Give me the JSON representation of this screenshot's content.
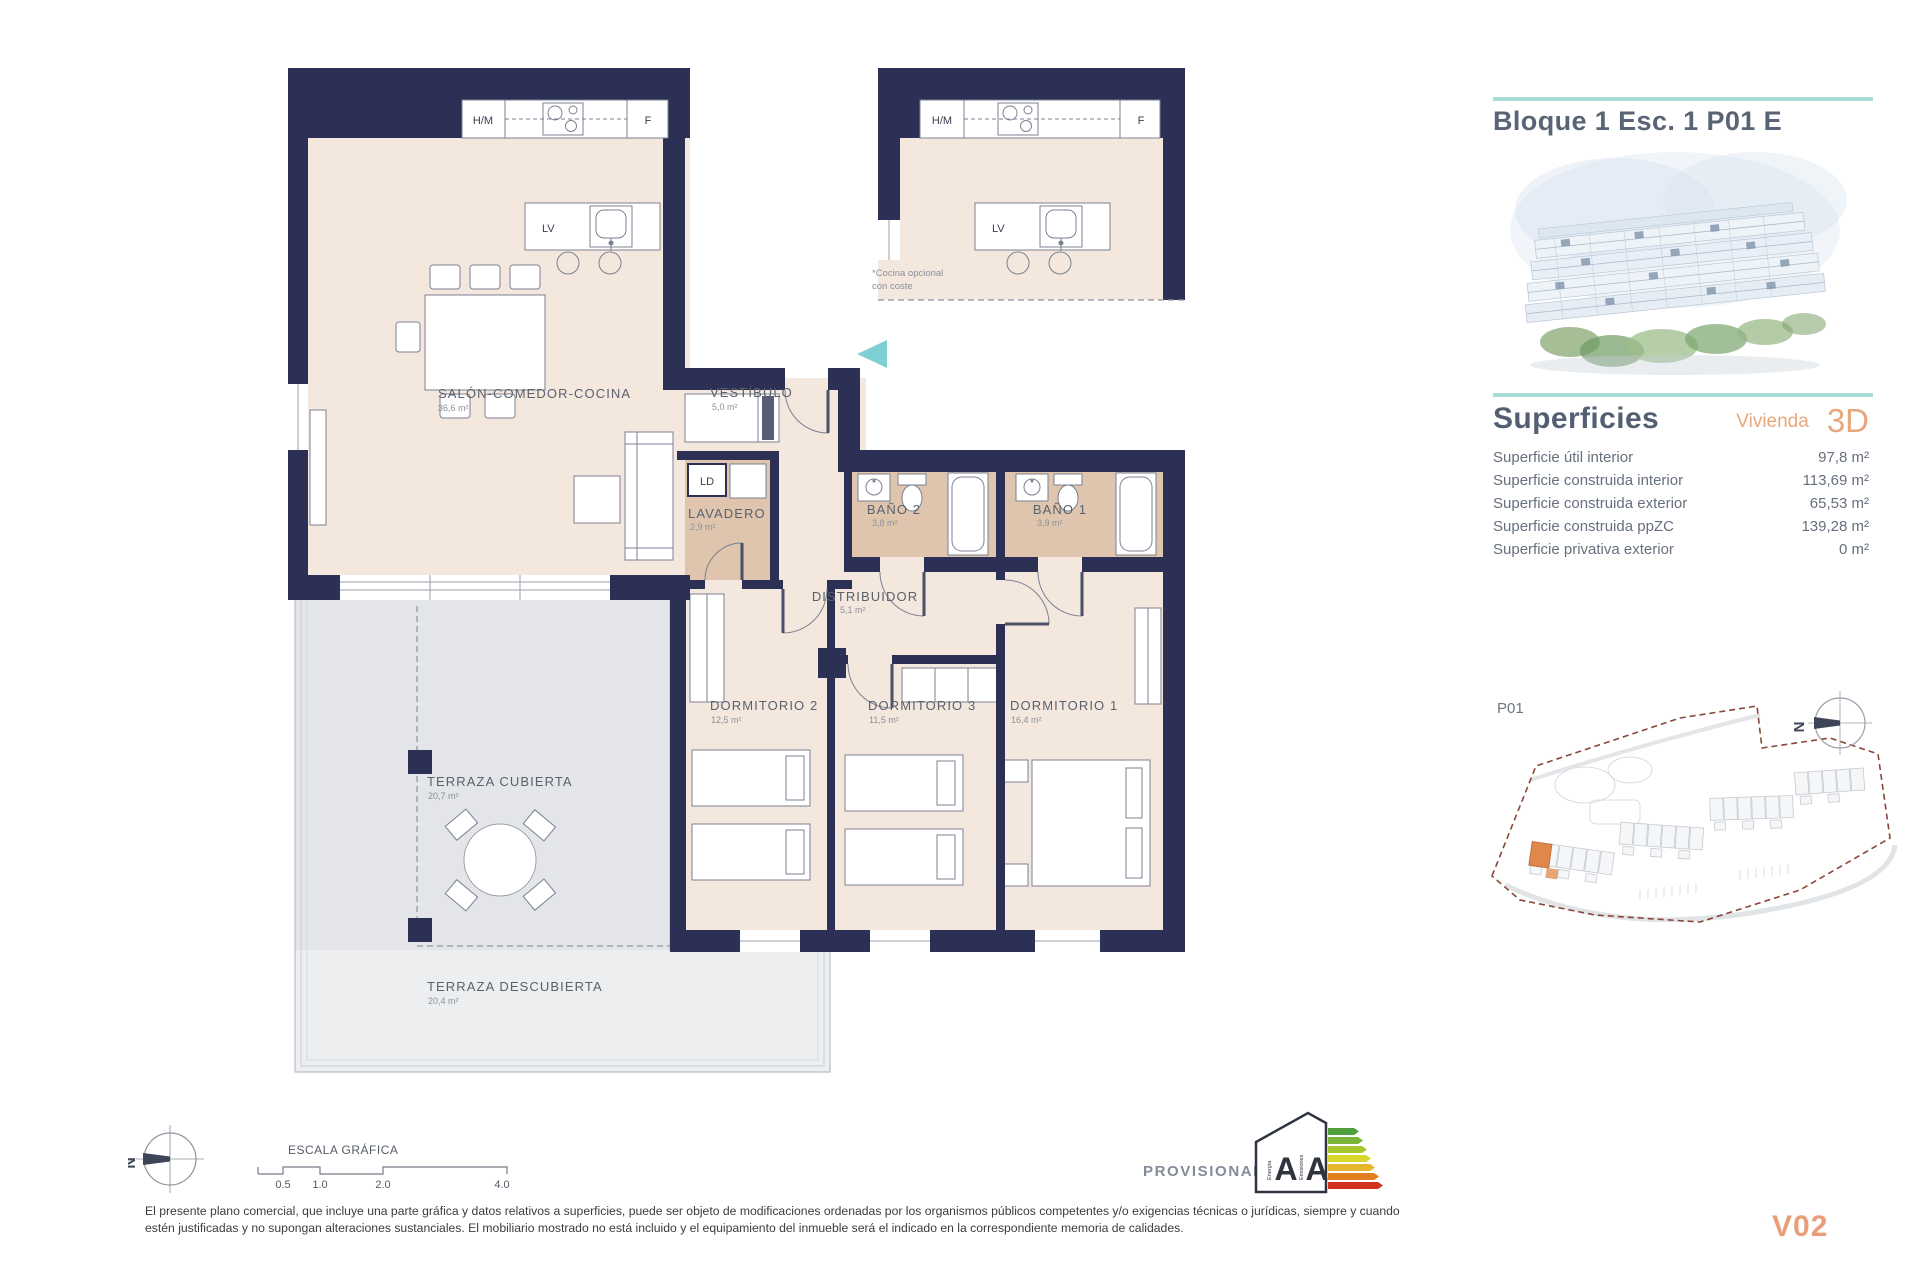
{
  "header": {
    "title": "Bloque 1 Esc. 1 P01 E"
  },
  "superficies": {
    "title": "Superficies",
    "subtitle": "Vivienda",
    "badge": "3D",
    "rows": [
      {
        "label": "Superficie útil interior",
        "value": "97,8 m²"
      },
      {
        "label": "Superficie construida interior",
        "value": "113,69 m²"
      },
      {
        "label": "Superficie construida exterior",
        "value": "65,53 m²"
      },
      {
        "label": "Superficie construida ppZC",
        "value": "139,28 m²"
      },
      {
        "label": "Superficie privativa exterior",
        "value": "0 m²"
      }
    ]
  },
  "siteplan": {
    "label": "P01"
  },
  "plan": {
    "kitchen": {
      "hm": "H/M",
      "f": "F",
      "lv": "LV",
      "ld": "LD"
    },
    "rooms": {
      "salon": {
        "name": "SALÓN-COMEDOR-COCINA",
        "area": "36,6 m²"
      },
      "vestibulo": {
        "name": "VESTÍBULO",
        "area": "5,0 m²"
      },
      "lavadero": {
        "name": "LAVADERO",
        "area": "2,9 m²"
      },
      "bano2": {
        "name": "BAÑO 2",
        "area": "3,8 m²"
      },
      "bano1": {
        "name": "BAÑO 1",
        "area": "3,9 m²"
      },
      "distribuidor": {
        "name": "DISTRIBUIDOR",
        "area": "5,1 m²"
      },
      "dorm2": {
        "name": "DORMITORIO 2",
        "area": "12,5 m²"
      },
      "dorm3": {
        "name": "DORMITORIO 3",
        "area": "11,5 m²"
      },
      "dorm1": {
        "name": "DORMITORIO 1",
        "area": "16,4 m²"
      },
      "terraza_cubierta": {
        "name": "TERRAZA CUBIERTA",
        "area": "20,7 m²"
      },
      "terraza_descubierta": {
        "name": "TERRAZA DESCUBIERTA",
        "area": "20,4 m²"
      }
    },
    "note_line1": "*Cocina opcional",
    "note_line2": "con coste"
  },
  "scale": {
    "title": "ESCALA GRÁFICA",
    "t1": "0.5",
    "t2": "1.0",
    "t3": "2.0",
    "t4": "4.0"
  },
  "compass": {
    "n": "N"
  },
  "energy": {
    "a1": "A",
    "a2": "A",
    "w1": "Energía",
    "w2": "Emisiones"
  },
  "footer": {
    "provisional": "PROVISIONAL",
    "version": "V02",
    "disclaimer": "El presente plano comercial, que incluye una parte gráfica y datos relativos a superficies, puede ser objeto de modificaciones ordenadas por los organismos públicos competentes y/o exigencias técnicas o jurídicas, siempre y cuando estén justificadas y no supongan alteraciones sustanciales. El mobiliario mostrado no está incluido y el equipamiento del inmueble será el indicado en la correspondiente memoria de calidades."
  },
  "colors": {
    "wall": "#2b3054",
    "accent_teal": "#a7dbd6",
    "accent_orange": "#e7a77d",
    "highlight": "#e0884b"
  }
}
